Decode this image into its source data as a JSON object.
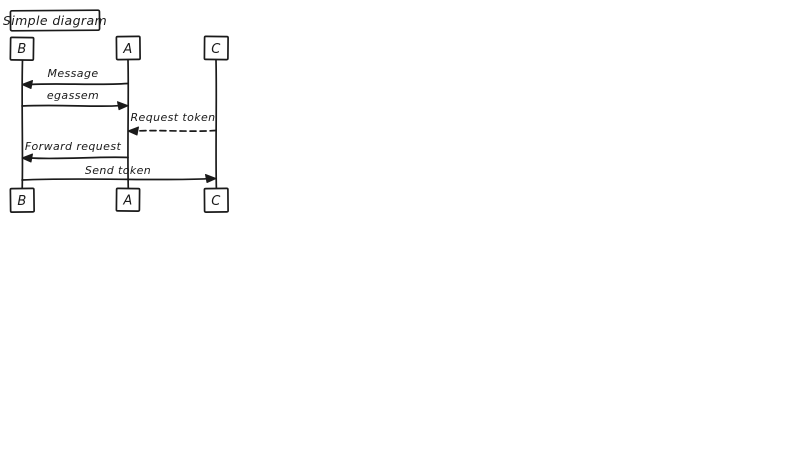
{
  "diagram": {
    "type": "sequence-diagram",
    "style": "hand-drawn",
    "title": "Simple diagram",
    "colors": {
      "ink": "#1a1a1a",
      "background": "#ffffff"
    },
    "actors": [
      {
        "id": "B",
        "label": "B"
      },
      {
        "id": "A",
        "label": "A"
      },
      {
        "id": "C",
        "label": "C"
      }
    ],
    "messages": [
      {
        "label": "Message",
        "from": "A",
        "to": "B",
        "line": "solid"
      },
      {
        "label": "egassem",
        "from": "B",
        "to": "A",
        "line": "solid"
      },
      {
        "label": "Request token",
        "from": "C",
        "to": "A",
        "line": "dashed"
      },
      {
        "label": "Forward request",
        "from": "A",
        "to": "B",
        "line": "solid"
      },
      {
        "label": "Send token",
        "from": "B",
        "to": "C",
        "line": "solid"
      }
    ]
  }
}
